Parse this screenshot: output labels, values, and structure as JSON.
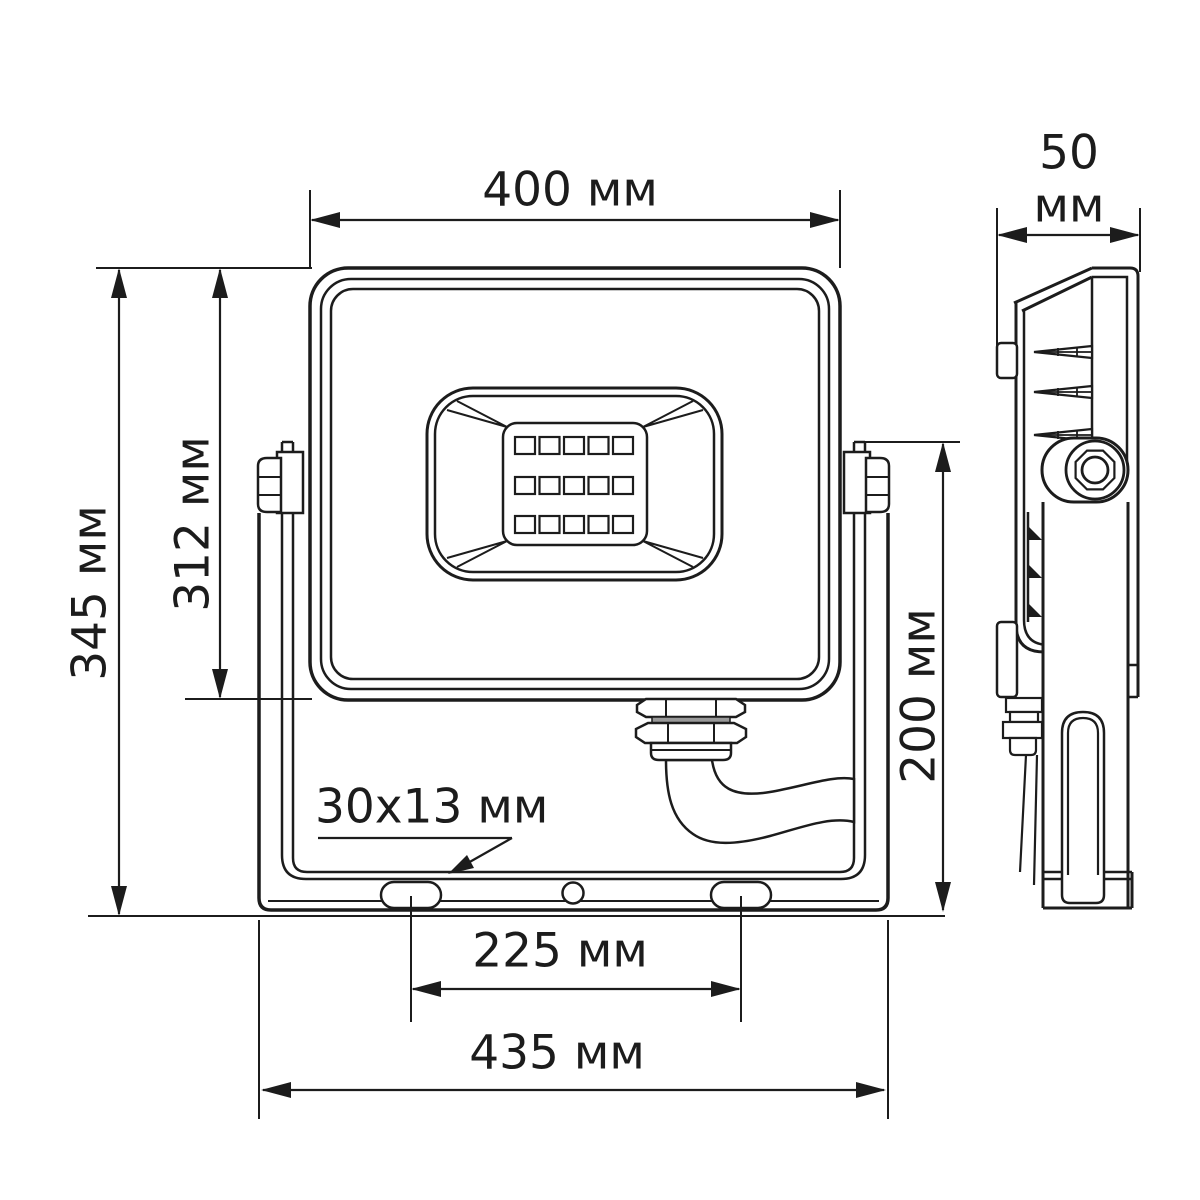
{
  "drawing": {
    "background": "#ffffff",
    "line_color": "#1c1c1c",
    "views": {
      "front": "front-view",
      "side": "side-view"
    },
    "dimensions": {
      "width": {
        "label": "400 мм"
      },
      "depth": {
        "value": "50",
        "unit": "мм"
      },
      "height_total": {
        "label": "345 мм"
      },
      "height_body": {
        "label": "312 мм"
      },
      "height_bracket": {
        "label": "200 мм"
      },
      "slot_size": {
        "label": "30x13 мм"
      },
      "hole_spacing": {
        "label": "225 мм"
      },
      "bracket_width": {
        "label": "435 мм"
      }
    },
    "led_grid": {
      "cols": [
        515,
        539.5,
        564,
        588.5,
        613
      ],
      "rows": [
        437,
        477,
        516
      ],
      "w": 20,
      "h": 17
    },
    "side_fins": [
      352,
      392,
      435
    ],
    "side_wedges": [
      534,
      572,
      611
    ]
  }
}
